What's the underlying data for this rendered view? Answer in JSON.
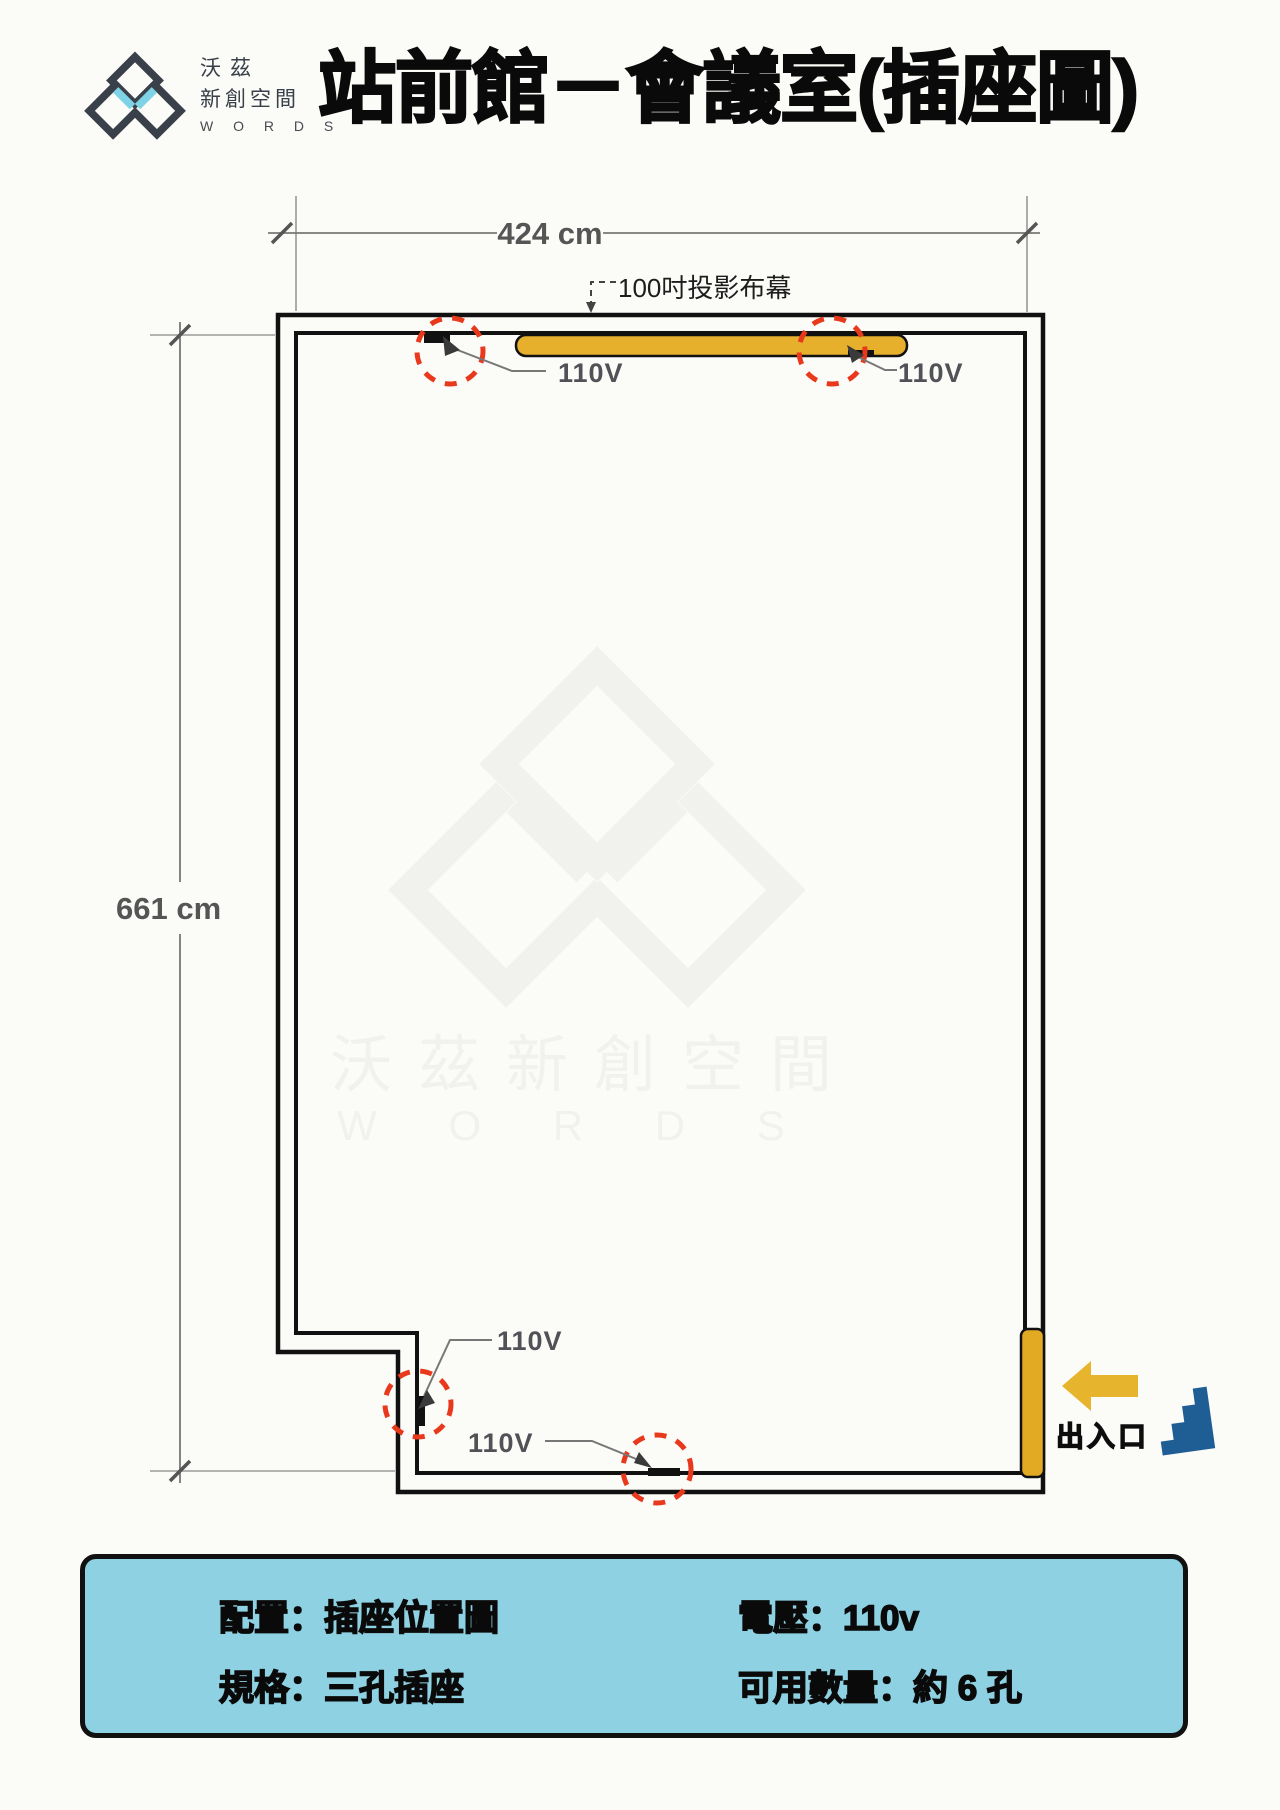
{
  "header": {
    "logo_line1": "沃茲",
    "logo_line2": "新創空間",
    "logo_line3": "W O R D S",
    "title": "站前館－會議室(插座圖)"
  },
  "plan": {
    "width_dim": "424 cm",
    "height_dim": "661 cm",
    "screen_label": "100吋投影布幕",
    "outlet_labels": [
      "110V",
      "110V",
      "110V",
      "110V"
    ],
    "entrance_label": "出入口"
  },
  "watermark": {
    "cjk": "沃茲新創空間",
    "latin": "W O R D S"
  },
  "info_box": {
    "row1_left": "配置：插座位置圖",
    "row1_right": "電壓：110v",
    "row2_left": "規格：三孔插座",
    "row2_right": "可用數量：約 6 孔"
  },
  "colors": {
    "accent_yellow": "#e7b02c",
    "door_yellow": "#e2a922",
    "outlet_red": "#e8391d",
    "info_box_bg": "#8ed1e2",
    "stairs_blue": "#1f5e94",
    "logo_blue": "#7fd3e6",
    "logo_dark": "#3a4049"
  }
}
